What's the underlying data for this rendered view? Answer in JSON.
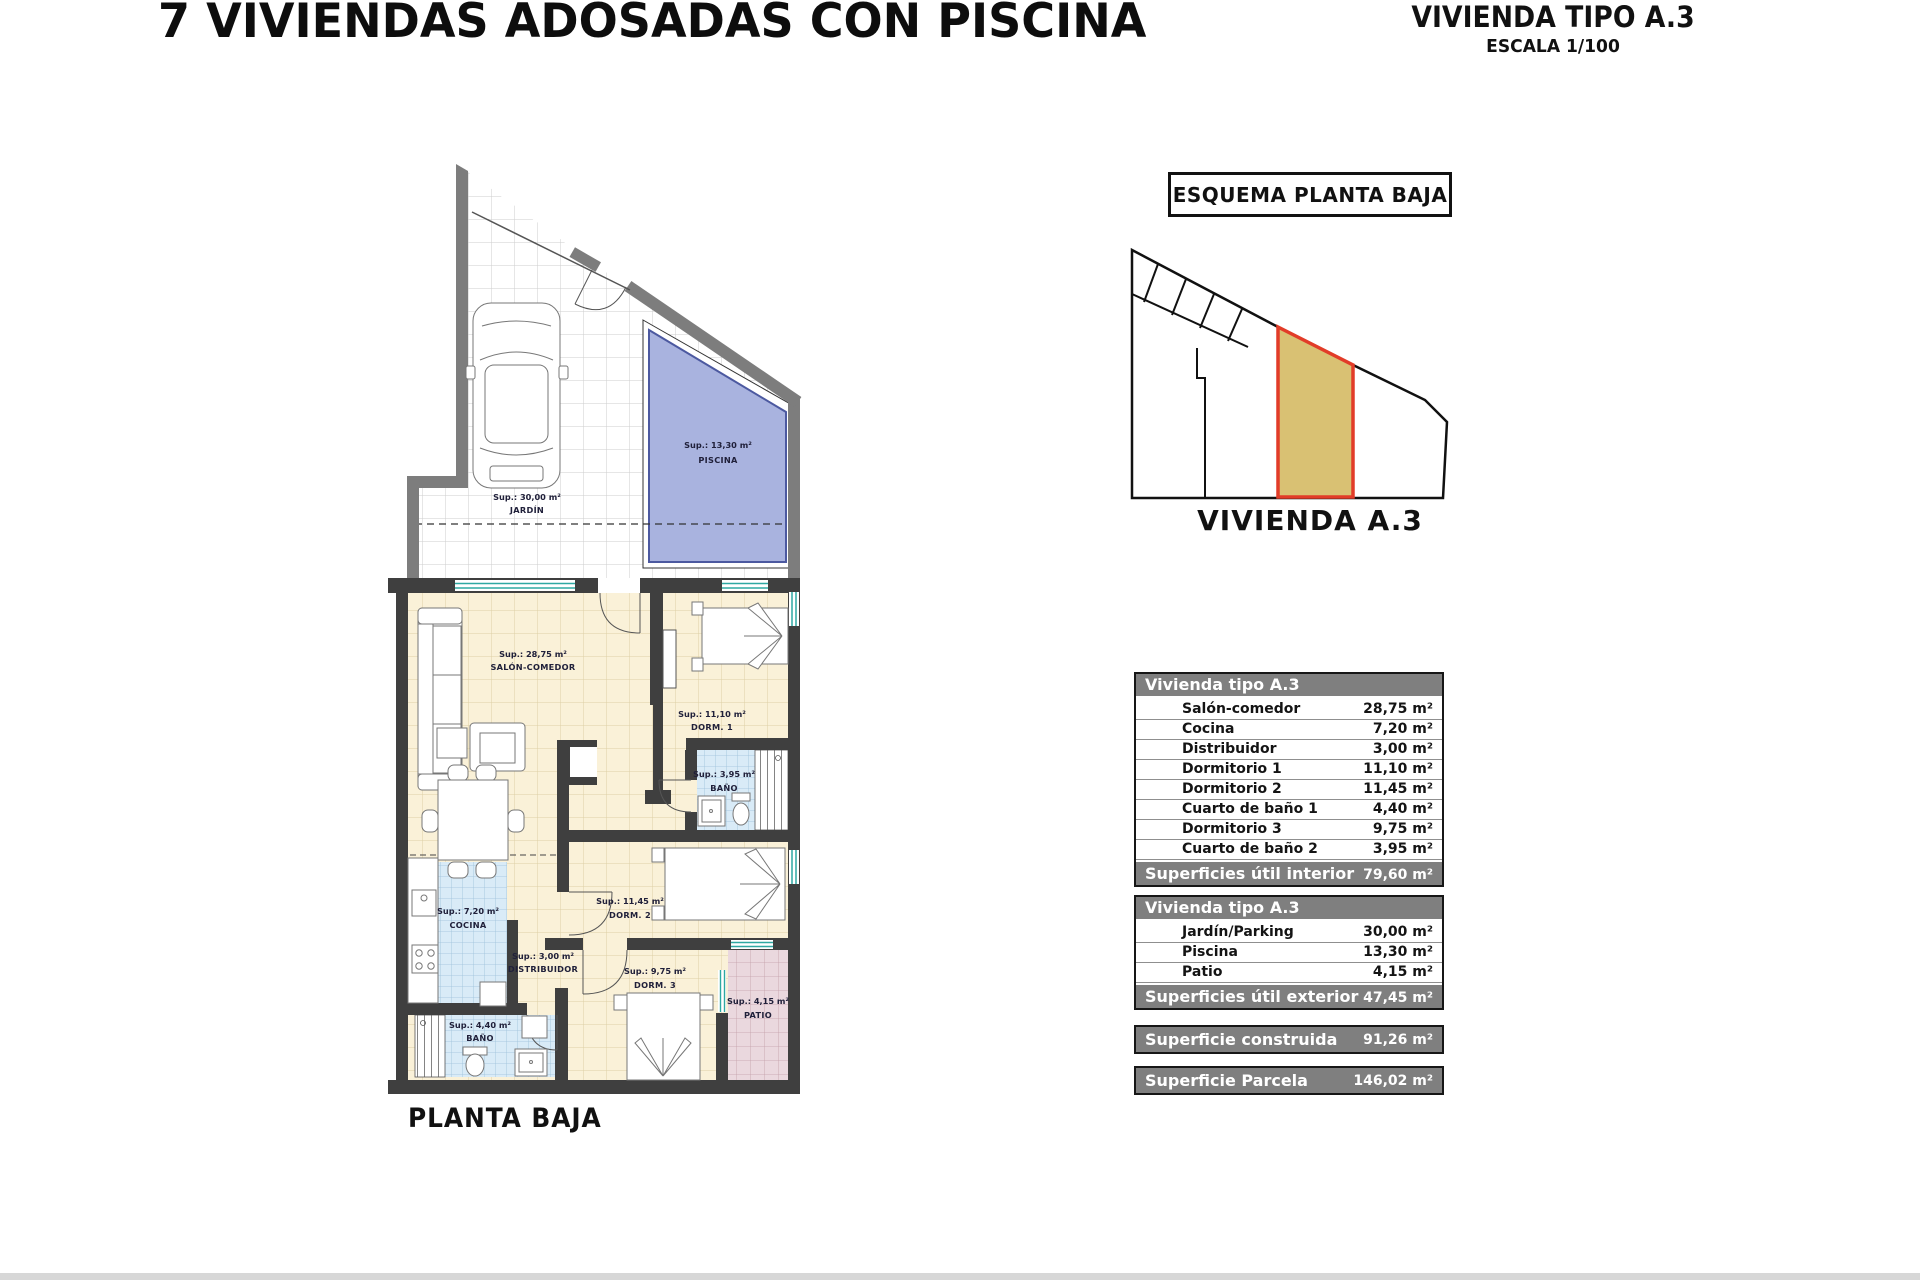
{
  "header": {
    "title": "7 VIVIENDAS ADOSADAS CON PISCINA",
    "type_label": "VIVIENDA TIPO A.3",
    "scale_label": "ESCALA 1/100"
  },
  "plan": {
    "caption": "PLANTA BAJA",
    "rooms": {
      "jardin": {
        "sup": "Sup.: 30,00 m²",
        "name": "JARDÍN"
      },
      "piscina": {
        "sup": "Sup.: 13,30 m²",
        "name": "PISCINA"
      },
      "salon": {
        "sup": "Sup.: 28,75 m²",
        "name": "SALÓN-COMEDOR"
      },
      "dorm1": {
        "sup": "Sup.: 11,10 m²",
        "name": "DORM. 1"
      },
      "bano2": {
        "sup": "Sup.: 3,95 m²",
        "name": "BAÑO"
      },
      "dorm2": {
        "sup": "Sup.: 11,45 m²",
        "name": "DORM. 2"
      },
      "cocina": {
        "sup": "Sup.: 7,20 m²",
        "name": "COCINA"
      },
      "distribuidor": {
        "sup": "Sup.: 3,00 m²",
        "name": "DISTRIBUIDOR"
      },
      "dorm3": {
        "sup": "Sup.: 9,75 m²",
        "name": "DORM. 3"
      },
      "bano1": {
        "sup": "Sup.: 4,40 m²",
        "name": "BAÑO"
      },
      "patio": {
        "sup": "Sup.: 4,15 m²",
        "name": "PATIO"
      }
    }
  },
  "schematic": {
    "box_label": "ESQUEMA PLANTA BAJA",
    "caption": "VIVIENDA A.3",
    "highlight_color": "#d9c173",
    "outline_color": "#e23c28"
  },
  "tables": {
    "interior": {
      "header": "Vivienda tipo A.3",
      "rows": [
        {
          "label": "Salón-comedor",
          "value": "28,75 m²"
        },
        {
          "label": "Cocina",
          "value": "7,20 m²"
        },
        {
          "label": "Distribuidor",
          "value": "3,00 m²"
        },
        {
          "label": "Dormitorio 1",
          "value": "11,10 m²"
        },
        {
          "label": "Dormitorio 2",
          "value": "11,45 m²"
        },
        {
          "label": "Cuarto de baño 1",
          "value": "4,40 m²"
        },
        {
          "label": "Dormitorio 3",
          "value": "9,75 m²"
        },
        {
          "label": "Cuarto de baño 2",
          "value": "3,95 m²"
        }
      ],
      "footer_label": "Superficies útil interior",
      "footer_value": "79,60 m²"
    },
    "exterior": {
      "header": "Vivienda tipo A.3",
      "rows": [
        {
          "label": "Jardín/Parking",
          "value": "30,00 m²"
        },
        {
          "label": "Piscina",
          "value": "13,30 m²"
        },
        {
          "label": "Patio",
          "value": "4,15 m²"
        }
      ],
      "footer_label": "Superficies útil exterior",
      "footer_value": "47,45 m²"
    },
    "construida": {
      "label": "Superficie construida",
      "value": "91,26 m²"
    },
    "parcela": {
      "label": "Superficie Parcela",
      "value": "146,02 m²"
    }
  },
  "colors": {
    "table_header_bg": "#7f7f7f",
    "pool_fill": "#a9b3df",
    "house_floor": "#faf1d8",
    "wet_room_tile": "#d9ebf7",
    "patio_fill": "#ead8de",
    "wall_dark": "#3f3f3f",
    "wall_outer": "#7d7d7d",
    "window_teal": "#2ea8a2"
  }
}
